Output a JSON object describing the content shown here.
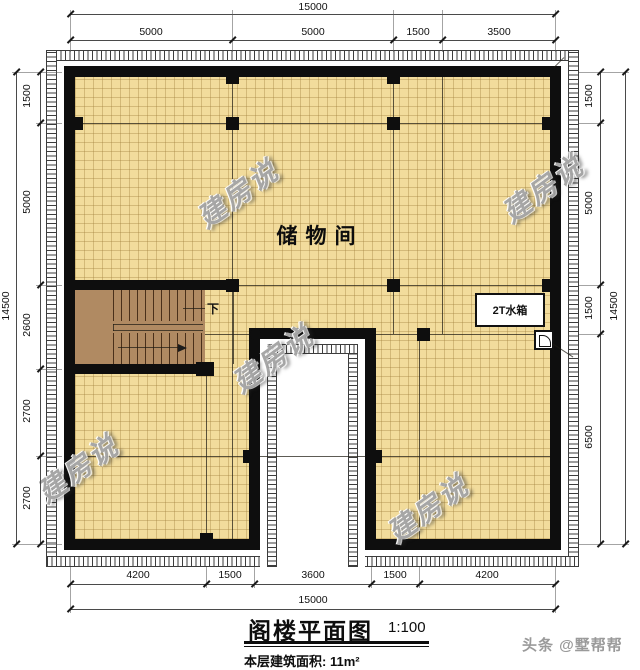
{
  "plan": {
    "room_label": "储物间",
    "water_tank_label": "2T水箱",
    "stairs_down_label": "下"
  },
  "dimensions": {
    "top": {
      "total": "15000",
      "segments": [
        "5000",
        "5000",
        "1500",
        "3500"
      ]
    },
    "bottom": {
      "total": "15000",
      "segments": [
        "4200",
        "1500",
        "3600",
        "1500",
        "4200"
      ]
    },
    "left": {
      "total": "14500",
      "segments": [
        "1500",
        "5000",
        "2600",
        "2700",
        "2700"
      ]
    },
    "right": {
      "total": "14500",
      "segments": [
        "1500",
        "5000",
        "1500",
        "6500"
      ]
    }
  },
  "titleblock": {
    "title": "阁楼平面图",
    "scale": "1:100",
    "area_label": "本层建筑面积:",
    "area_value": "11m²"
  },
  "watermark": {
    "text": "建房说",
    "byline": "头条 @墅帮帮"
  },
  "colors": {
    "wall": "#0e0e0e",
    "floor": "#f2dc9c",
    "floor_grid": "#a08040",
    "stair": "#b08a62",
    "void": "#ffffff",
    "watermark_gray": "#949494"
  }
}
